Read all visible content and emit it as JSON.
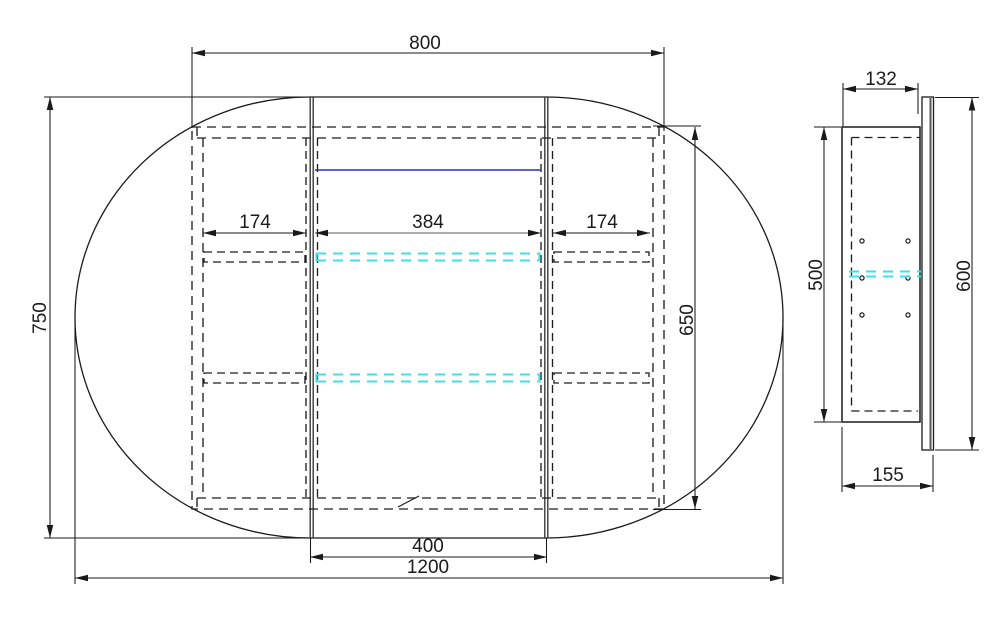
{
  "front_view": {
    "dim_cabinet_width": "800",
    "dim_overall_height": "750",
    "dim_left_door_width": "174",
    "dim_center_opening_width": "384",
    "dim_right_door_width": "174",
    "dim_cabinet_height": "650",
    "dim_center_door_width": "400",
    "dim_overall_width": "1200"
  },
  "side_view": {
    "dim_cabinet_depth": "132",
    "dim_cabinet_height": "500",
    "dim_mirror_height": "600",
    "dim_overall_depth": "155"
  },
  "colors": {
    "line_black": "#1a1a1a",
    "divider_gray": "#3a3a3a",
    "glass_shelf_cyan": "#43dfe9",
    "accent_blue": "#2b2bc4"
  }
}
